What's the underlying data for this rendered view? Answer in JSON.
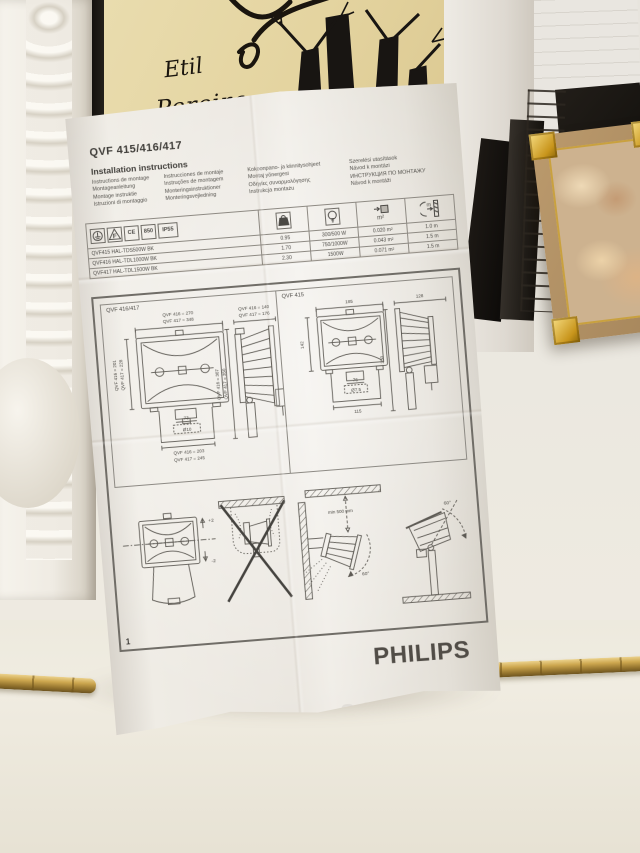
{
  "scene": {
    "brand": "PHILIPS",
    "poster": {
      "line1": "Etil",
      "line2": "Pereira"
    },
    "colors": {
      "paper": "#e8e4dd",
      "print": "#4b4945",
      "brass": "#cda74f",
      "gold_frame": "#c8951c",
      "poster_cream": "#e4d4a0"
    }
  },
  "icons": {
    "earth": "earth-ground-symbol",
    "f_triangle": "f-in-triangle-symbol",
    "weight": "weight-kg-symbol",
    "lamp": "bulb-symbol",
    "area": "wind-area-m2-symbol",
    "distance": "min-distance-symbol"
  },
  "doc": {
    "model": "QVF 415/416/417",
    "title": "Installation instructions",
    "translations": {
      "col1": [
        "Instructions de montage",
        "Montageanleitung",
        "Montage instruktie",
        "Istruzioni di montaggio"
      ],
      "col2": [
        "Instrucciones de montaje",
        "Instruções de montagem",
        "Monteringsinstruktioner",
        "Monteringsvejledning"
      ],
      "col3": [
        "Kokoonpano- ja kiinnitysohjeet",
        "Montaj yönergesi",
        "Οδηγίες συναρμολόγησης",
        "Instrukcja montażu"
      ],
      "col4": [
        "Szerelési utasítások",
        "Návod k montázi",
        "ИНСТРУКЦИЯ ПО МОНТАЖУ",
        "Návod k montáži"
      ]
    },
    "certs": {
      "f": "F",
      "ce": "CE",
      "temp": "850",
      "ip": "IP55"
    },
    "col_icons": {
      "weight": "kg",
      "area": "m²",
      "distance": "m"
    },
    "table": [
      {
        "name": "QVF415 HAL-TDS500W BK",
        "kg": "0.95",
        "watt": "300/500 W",
        "area": "0.020 m²",
        "dist": "1.0 m"
      },
      {
        "name": "QVF416 HAL-TDL1000W BK",
        "kg": "1.70",
        "watt": "750/1000W",
        "area": "0.043 m²",
        "dist": "1.5 m"
      },
      {
        "name": "QVF417 HAL-TDL1500W BK",
        "kg": "2.30",
        "watt": "1500W",
        "area": "0.071 m²",
        "dist": "1.5 m"
      }
    ],
    "panel1": {
      "label": "QVF 416/417",
      "front_top1": "QVF 416 = 270",
      "front_top2": "QVF 417 = 348",
      "front_left1": "QVF 416 = 201",
      "front_left2": "QVF 417 = 228",
      "front_b1": "73",
      "front_b2": "Ø10",
      "front_b3": "QVF 416 = 203",
      "front_b4": "QVF 417 = 245",
      "side_top1": "QVF 416 = 140",
      "side_top2": "QVF 417 = 176",
      "side_left1": "QVF 416 = 307",
      "side_left2": "QVF 417 = 350"
    },
    "panel2": {
      "label": "QVF 415",
      "front_top": "185",
      "front_left": "142",
      "front_b1": "76",
      "front_b2": "Ø7.5",
      "front_b3": "115",
      "side_top": "128",
      "side_left": "250"
    },
    "mounting": {
      "aim_up": "+2",
      "aim_down": "-2",
      "min_dist": "min 500 mm",
      "angle_wall": "60°",
      "angle_pole": "60°"
    },
    "page_number": "1"
  }
}
